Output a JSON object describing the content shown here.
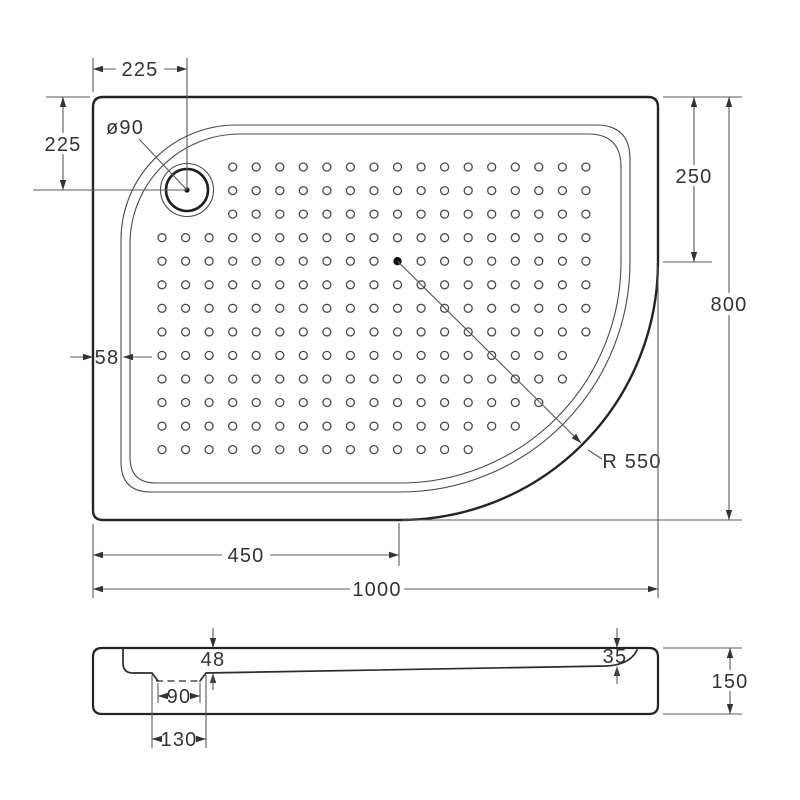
{
  "drawing": {
    "product": "quadrant-shower-tray-technical-drawing",
    "colors": {
      "line": "#242424",
      "thin_line": "#4a4a4a",
      "dimension_line": "#5a5a5a",
      "text": "#333333",
      "background": "#ffffff"
    },
    "top_view": {
      "dim_drain_offset_x": "225",
      "dim_drain_offset_y": "225",
      "drain_diameter_label": "ø90",
      "dim_right_straight_edge": "250",
      "dim_overall_depth": "800",
      "dim_rim_width": "58",
      "corner_radius_label": "R 550",
      "dim_bottom_straight_edge": "450",
      "dim_overall_width": "1000"
    },
    "section_view": {
      "dim_depth_at_drain": "48",
      "dim_depth_at_edge": "35",
      "dim_recess_bottom_width": "90",
      "dim_recess_top_width": "130",
      "dim_overall_height": "150"
    }
  }
}
